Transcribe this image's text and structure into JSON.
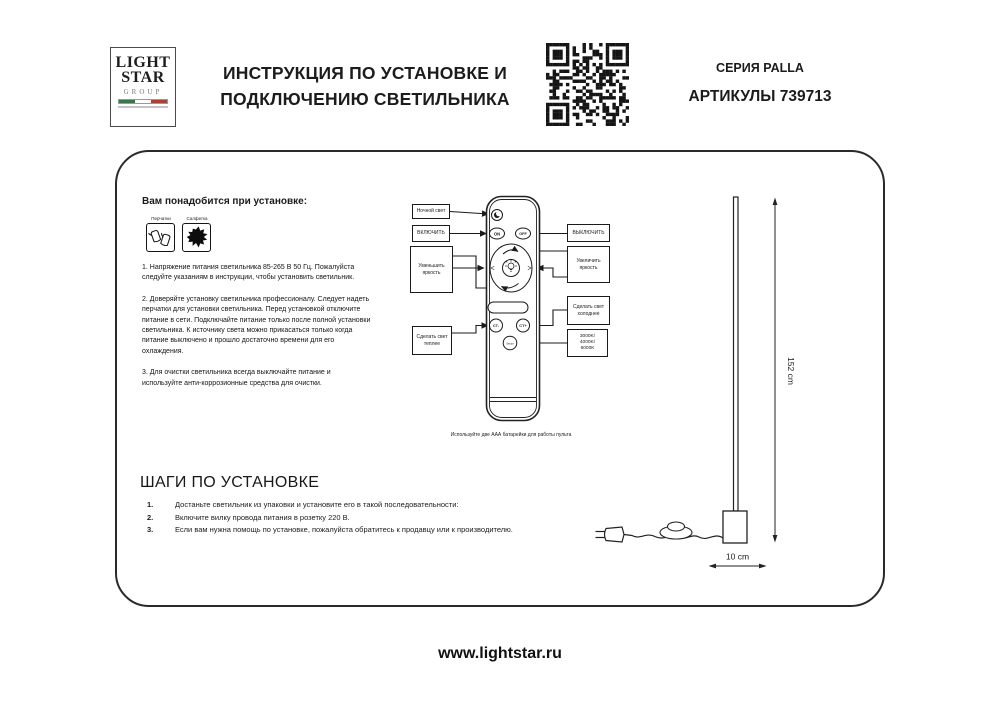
{
  "header": {
    "logo": {
      "line1": "LIGHT",
      "line2": "STAR",
      "line3": "GROUP"
    },
    "title_line1": "ИНСТРУКЦИЯ ПО УСТАНОВКЕ И",
    "title_line2": "ПОДКЛЮЧЕНИЮ СВЕТИЛЬНИКА",
    "series": "СЕРИЯ PALLA",
    "articul": "АРТИКУЛЫ 739713"
  },
  "manual": {
    "need_title": "Вам понадобится при установке:",
    "tools": [
      {
        "label": "Перчатки"
      },
      {
        "label": "Салфетка"
      }
    ],
    "paragraphs": [
      "1. Напряжение питания светильника 85-265 В 50 Гц. Пожалуйста следуйте указаниям в инструкции, чтобы установить светильник.",
      "2. Доверяйте установку светильника профессионалу. Следует надеть перчатки для установки светильника. Перед установкой отключите питание в сети. Подключайте питание только после полной установки светильника. К источнику света можно прикасаться только когда питание выключено и прошло достаточно времени для его охлаждения.",
      "3. Для очистки светильника всегда выключайте питание и используйте анти-коррозионные средства для очистки."
    ],
    "remote": {
      "labels": {
        "night": "Ночной свет",
        "on": "ВКЛЮЧИТЬ",
        "off": "ВЫКЛЮЧИТЬ",
        "dim": "Уменьшить яркость",
        "brighten": "Увеличить яркость",
        "warm": "Сделать свет теплее",
        "cold": "Сделать свет холоднее",
        "kelvin_line1": "3000K/",
        "kelvin_line2": "4000K/",
        "kelvin_line3": "6000K"
      },
      "buttons": {
        "on": "ON",
        "off": "OFF",
        "ct_minus": "CT-",
        "ct_plus": "CT+",
        "sector": "Sector"
      },
      "battery_note": "Используйте две ААА батарейки для работы пульта"
    },
    "dimensions": {
      "height": "152 cm",
      "base": "10 cm"
    },
    "steps_title": "ШАГИ ПО УСТАНОВКЕ",
    "steps": [
      {
        "num": "1.",
        "text": "Достаньте светильник из упаковки и установите его в такой последовательности:"
      },
      {
        "num": "2.",
        "text": "Включите вилку провода питания в розетку 220 В."
      },
      {
        "num": "3.",
        "text": "Если вам нужна помощь по установке, пожалуйста обратитесь к продавцу или к производителю."
      }
    ]
  },
  "footer": {
    "site": "www.lightstar.ru"
  },
  "colors": {
    "ink": "#1b1b1b",
    "flag_green": "#2e7d46",
    "flag_red": "#c0392b"
  }
}
